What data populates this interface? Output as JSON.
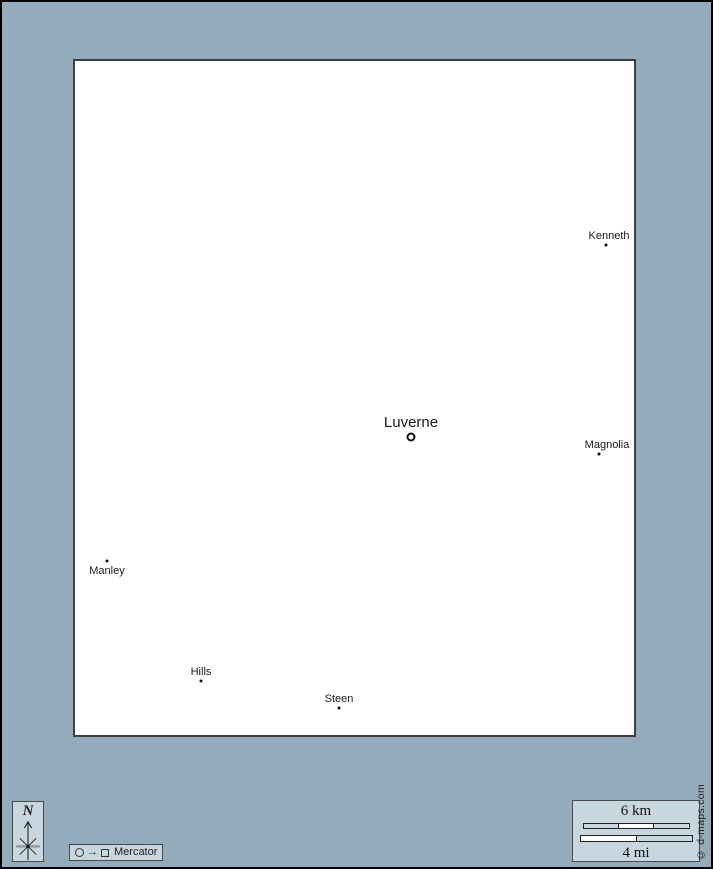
{
  "map": {
    "cities": [
      {
        "name": "Kenneth",
        "marker": "dot"
      },
      {
        "name": "Luverne",
        "marker": "ring",
        "major": true
      },
      {
        "name": "Magnolia",
        "marker": "dot"
      },
      {
        "name": "Manley",
        "marker": "dot"
      },
      {
        "name": "Hills",
        "marker": "dot"
      },
      {
        "name": "Steen",
        "marker": "dot"
      }
    ]
  },
  "compass": {
    "north_label": "N"
  },
  "legend": {
    "projection_label": "Mercator",
    "arrow_glyph": "→"
  },
  "scale": {
    "km_label": "6 km",
    "mi_label": "4 mi"
  },
  "credit": {
    "text": "© d-maps.com"
  },
  "colors": {
    "background": "#94abbb",
    "panel": "#c8d7df",
    "ink": "#1a1a1a"
  }
}
